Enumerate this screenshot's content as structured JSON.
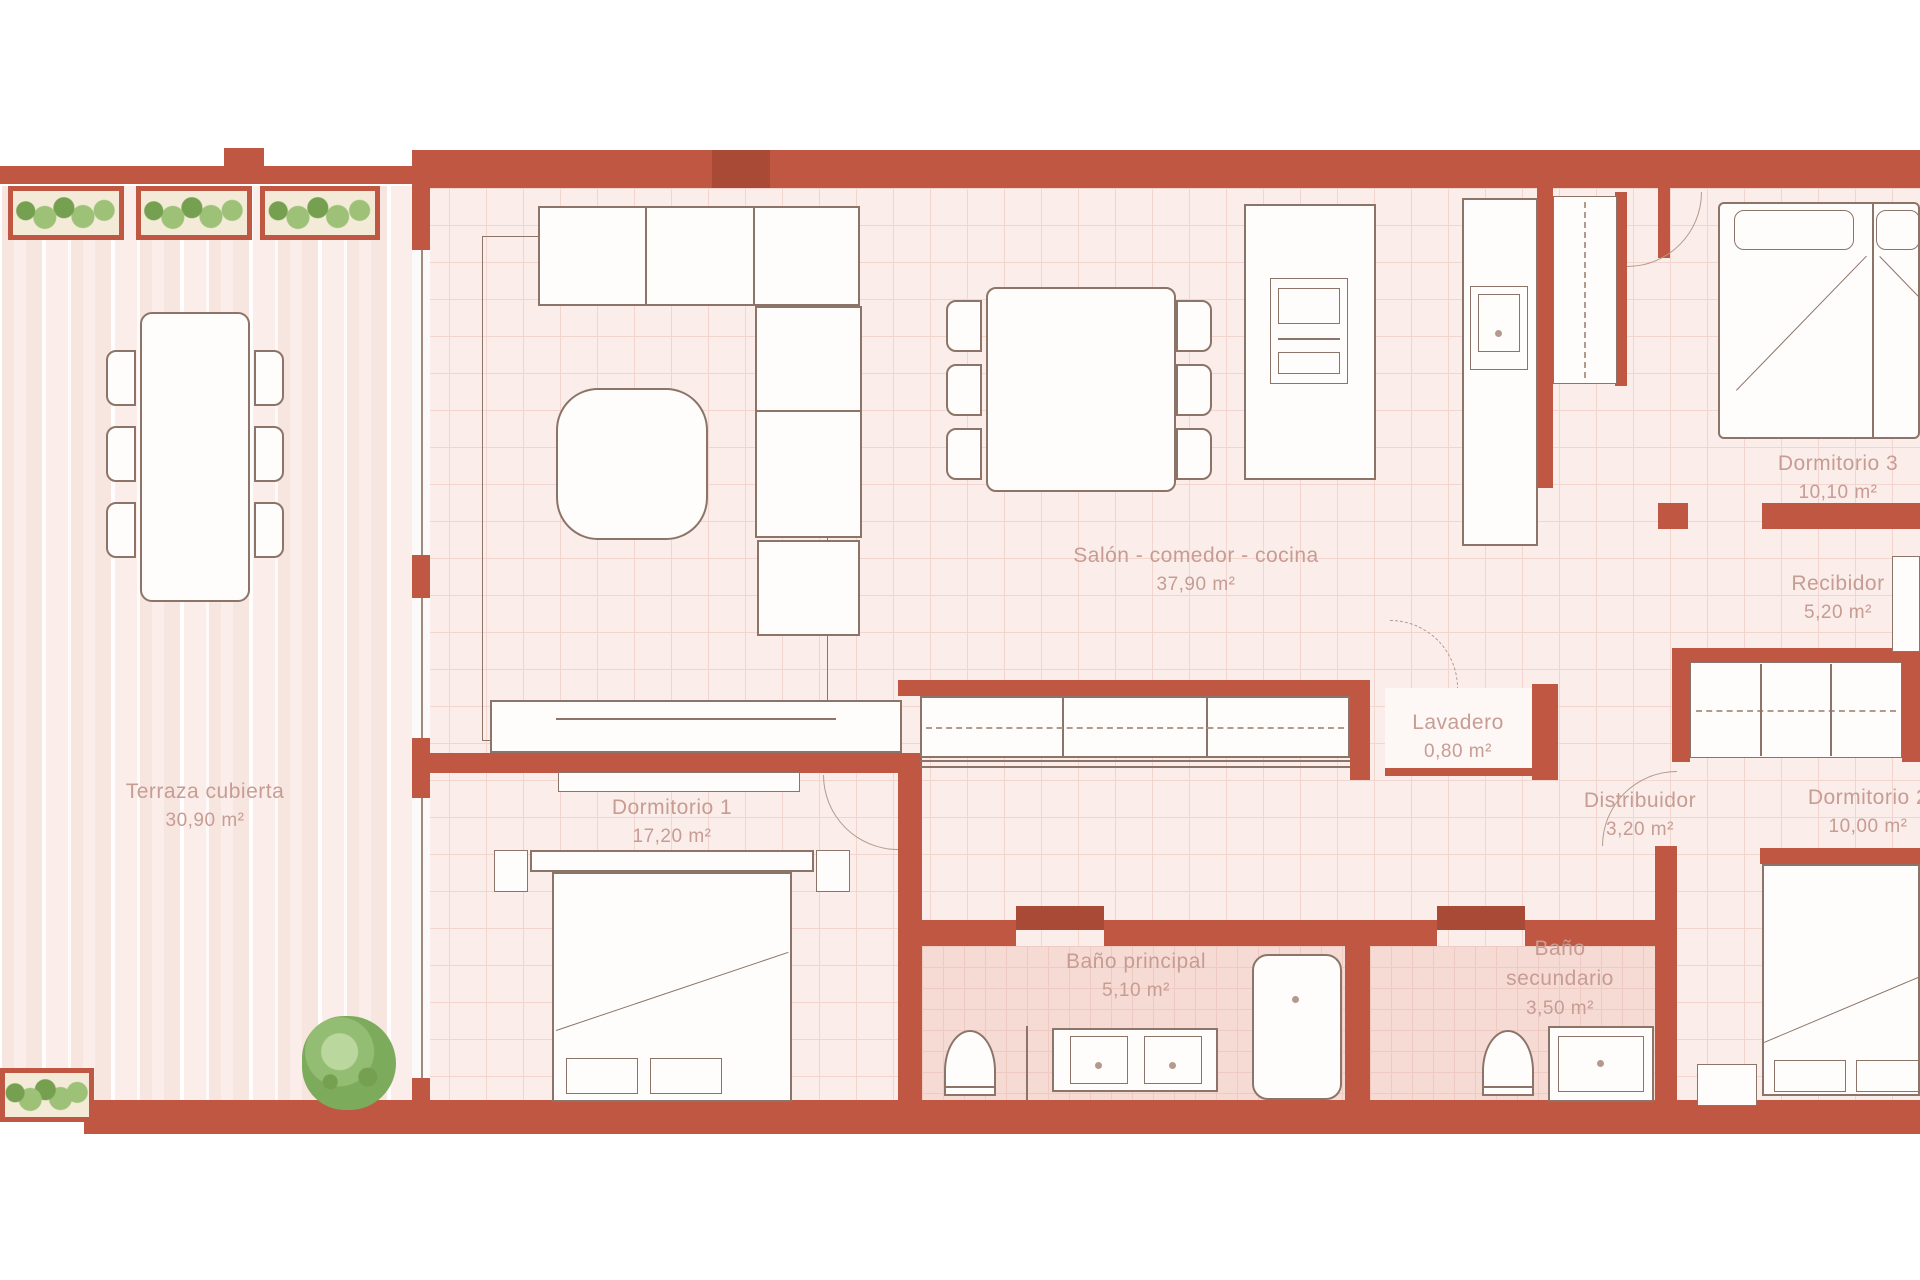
{
  "plan": {
    "rooms": [
      {
        "name": "Terraza cubierta",
        "area": "30,90 m²"
      },
      {
        "name": "Salón - comedor - cocina",
        "area": "37,90 m²"
      },
      {
        "name": "Dormitorio 1",
        "area": "17,20 m²"
      },
      {
        "name": "Dormitorio 3",
        "area": "10,10 m²"
      },
      {
        "name": "Recibidor",
        "area": "5,20 m²"
      },
      {
        "name": "Lavadero",
        "area": "0,80 m²"
      },
      {
        "name": "Distribuidor",
        "area": "3,20 m²"
      },
      {
        "name": "Dormitorio 2",
        "area": "10,00 m²"
      },
      {
        "name": "Baño principal",
        "area": "5,10 m²"
      },
      {
        "name": "Baño secundario",
        "area": "3,50 m²"
      }
    ],
    "colors": {
      "wall": "#bf5743",
      "wall_dark": "#a84a36",
      "floor": "#faedea",
      "grid": "#f1d5ce",
      "tile": "#f6dbd5",
      "tile_grid": "#eecac2",
      "line": "#8c7568",
      "line_soft": "#b39a8d",
      "label": "#c79c93",
      "deck_a": "#f7e5e0",
      "deck_b": "#fbeeea",
      "plant": "#9dc177",
      "plant_dark": "#74a050"
    }
  }
}
